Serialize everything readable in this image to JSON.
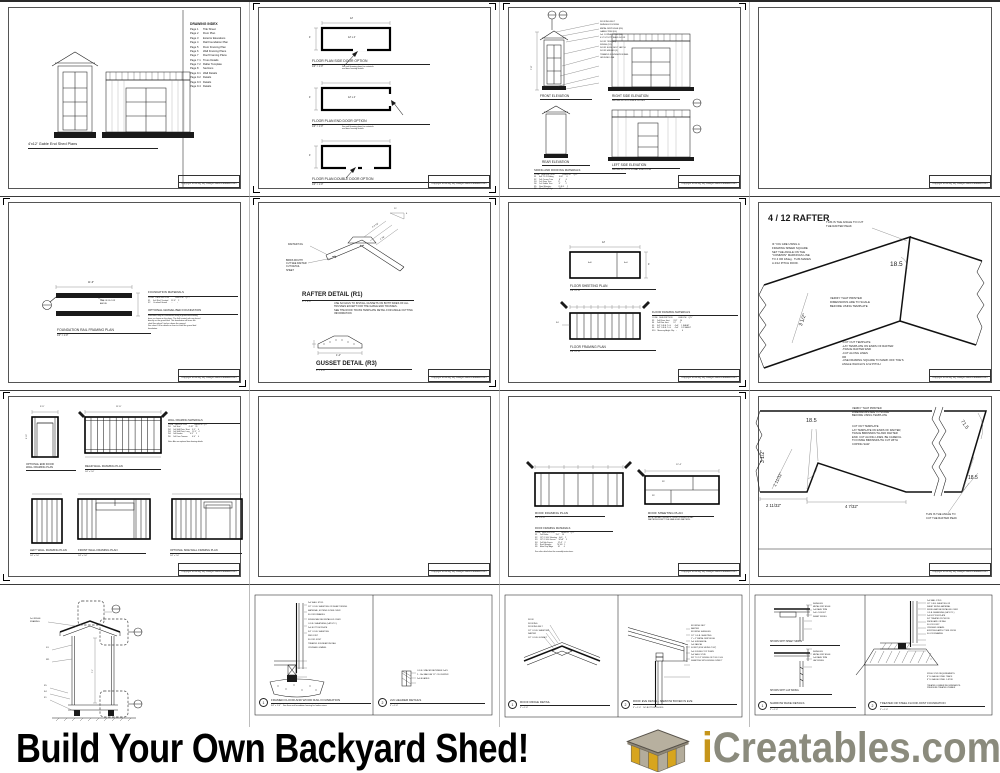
{
  "footer": {
    "headline": "Build Your Own Backyard Shed!",
    "brand": {
      "i": "i",
      "name": "Creatables",
      "dot": ".",
      "tld": "com"
    },
    "colors": {
      "gold": "#C6951A",
      "gray": "#8B8B7D",
      "dot": "#8B8B7D",
      "roof": "#b7b09f",
      "panel_gold": "#D7A51E",
      "panel_gray": "#b3ac9b"
    }
  },
  "titleblock": "Copyright 2012 Big Sky Designs   www.icreatables.com",
  "common": {
    "q": "1/4\" = 1'-0\"",
    "three": "3\" = 1'-0\""
  },
  "sheets": {
    "s1": {
      "index_title": "DRAWING INDEX",
      "index": "Page 1      Title Sheet\nPage 2      Floor Plan\nPage 3      Exterior Elevations\nPage 4      Rail Foundation Plan\nPage 5      Floor Framing Plan\nPage 6      Wall Framing Plans\nPage 7      Roof Framing Plans\nPage 7.1   Truss Details\nPage 7.2   Rafter Template\nPage 8      Sections\nPage 9.1   Wall Details\nPage 9.2   Details\nPage 9.3   Details\nPage 9.4   Details",
      "caption": "4'x12' Gable End Shed Plans"
    },
    "s2": {
      "plan1": "FLOOR PLAN SIDE DOOR OPTION",
      "plan2": "FLOOR PLAN END DOOR OPTION",
      "plan3": "FLOOR PLAN DOUBLE DOOR OPTION",
      "note": "See wall framing plans for materials\nand door framing details.",
      "dim_w": "12'",
      "dim_h": "4'",
      "room": "12' x 4'"
    },
    "s3": {
      "front": "FRONT ELEVATION",
      "right": "RIGHT SIDE ELEVATION",
      "right_sub": "SHOWN WITH DOUBLE DOORS",
      "rear": "REAR ELEVATION",
      "left": "LEFT SIDE ELEVATION",
      "left_sub": "SHOWN WITH OPTIONAL SIDE DOOR",
      "callouts": "ROOFING FELT\nSHINGLE ROOFING\nMETAL DRIP EDGE (R6)\nGABLE TRIM (D6)\n1x4 CORNER TRIM (S2)\n4'-0\" UTILITY SHED DOOR\nDOOR TRIM (D3)\nSIDING (S1)\nDOOR SLIDE BOLT LATCH\nDOOR HINGES (3)\nTREATED FOUNDATION RAIL\nGROUND LINE",
      "dim": "7'-8\"",
      "mat_title": "SIDING AND ROOFING MATERIALS",
      "materials": "CODE   DESCRIPTION               LENGTH      QTY\nS1     4x8 T1-11 Siding          4'x8'       6\nS2     1x4 Corner Trim           8'          6\nD3     1x4 Door Trim             8'          4\nD6     1x4 Gable Trim            8'          2\nR5     Roof Shingles             70 S.F.     1\nR6     Metal Drip Edge           10'         4"
    },
    "s5": {
      "label": "FOUNDATION RAIL FRAMING PLAN",
      "dim": "11'-6\"",
      "note": "LINE OF FLOOR\nABOVE",
      "mat_title": "FOUNDATION MATERIALS",
      "materials": "CODE   DESCRIPTION           LENGTH    QTY\nF1     4x4 Rail, Treated     11'-6\"    2\nF2     Crushed Gravel        -         -",
      "opt_title": "OPTIONAL GRAVEL BED FOUNDATION",
      "opt_text": "Shed floor may be constructed using a gravel bed leveling\nbase as shown on the plans. The 4x4 treated rails are placed\ndirectly on the gravel bed. This foundation will leave the\nshed floor about 5 inches above the ground.\nSee sheet 9.4 for details on how to install the gravel bed\nfoundation."
    },
    "s6": {
      "tail": "RAFTER TAIL",
      "birds": "BIRDS MOUTH\nCUT SEE RAFTER\nCUT DETAIL\nSHEET",
      "heading": "RAFTER DETAIL (R1)",
      "note": "USE 6d NAILS TO INSTALL GUSSETS ON BOTH SIDES OF ALL\nTRUSSES EXCEPT FOR THE GABLE END TRUSSES.\nSEE THE ROOF TRUSS TEMPLATE DETAIL FOR ANGLE CUTTING\nINFORMATION",
      "dim1": "2'-3 7/8\"",
      "dim2": "4 7/8\"",
      "slope12": "12",
      "slope4": "4",
      "gheading": "GUSSET DETAIL (R3)",
      "gdim": "1'-4\""
    },
    "s7": {
      "slabel": "FLOOR SHEETING PLAN",
      "flabel": "FLOOR FRAMING PLAN",
      "dim_w": "12'",
      "dim_h": "4'",
      "p1": "4x8",
      "p2": "4x4",
      "rim": "F4",
      "ttitle": "FLOOR FRAMING MATERIALS",
      "table": "CODE   DESCRIPTION           LENGTH    QTY\nF3     2x4 Floor Joist       3'-9\"     10\nF4     2x4 Rim Joist         12'       2\nF5     3/4\" O.S.B. T+G       4'x8'     1 SHEET\nF6     3/4\" O.S.B. T+G       4'x4'     1/2 SHEET\nF10    Masonry Angle Clip    -         6"
    },
    "s8": {
      "title": "4 / 12 RAFTER",
      "peak_note": "THIS IS THE ANGLE TO CUT\nTHE RAFTER PEAK",
      "speed_note": "IF YOU ARE USING A\nFRAMING SPEED SQUARE\nSET THE ANGLE ON THE\n\"COMMON\" MARKINGS LINE\nTO 4 OR 18deg.  THIS MAKES\nA 4/12 PITCH ROOF.",
      "angle": "18.5",
      "verify": "VERIFY THAT PRINTED\nDIMENSIONS ARE TO SCALE\nBEFORE USING TEMPLATE",
      "steps": "-CUT OUT TEMPLATE\n-LAY TEMPLATE ON ENDS OF RAFTER\n-TRACE RAFTER END\n-CUT ALONG LINES\nOR\n-USE FRAMING SQUARE TO MARK OFF TOE'S\nANGLE WHICH IS 4/12 PITCH",
      "dim": "3 1/2\""
    },
    "s9": {
      "t1": "OPTIONAL END DOOR\nWALL FRAMING PLAN",
      "t2": "REAR WALL FRAMING PLAN",
      "t3": "LEFT WALL FRAMING PLAN",
      "t4": "FRONT WALL FRAMING PLAN",
      "t5": "OPTIONAL SIDE WALL FRAMING PLAN",
      "ttitle": "WALL FRAMING MATERIALS",
      "table": "CODE   DESCRIPTION              L0ENGTH   QTY\nW1     2x4 Stud                 6'-10\"    26\nW2     2x4 Wall Plate, Short    3'-5\"     4\nW3     2x4 Wall Plate, Long     11'-5\"    4\nW4     2x6 Header               4'-5\"     2\nW5     2x4 Door Trimmer         6'-4\"     4",
      "note": "Note: Also see optional door framing details.",
      "d1": "3'-5\"",
      "d2": "11'-5\"",
      "d3": "6'-10\""
    },
    "s11": {
      "frlabel": "ROOF FRAMING PLAN",
      "ftitle": "ROOF FRAMING MATERIALS",
      "ftable": "CODE   DESCRIPTION             LENGTH    QTY\nR1     2x4 Rafter              3'-0\"     14\nR2     1/2\" O.S.B. Sheeting    4'x8'     2\nR3     1/2\" O.S.B. Gusset      16\"x8\"    5\nR4     2x4 Sub Fascia          12'-4\"    2\nR5     Roof Shingles           70 S.F.   1\nR6     Metal Drip Edge         10'       4",
      "fnote": "See rafter detail sheet for assembly instructions.",
      "shlabel": "ROOF SHEETING PLAN",
      "shnote": "NOTE: INSTALL GUSSETS ON BOTH SIDES OF ALL\nRAFTERS EXCEPT THE GABLE END RAFTERS.",
      "dim": "12'-4\"",
      "p1": "R2",
      "p2": "R2"
    },
    "s12": {
      "verify": "VERIFY THAT PRINTED\nDIMENSIONS ARE TO SCALE\nBEFORE USING TEMPLATE",
      "steps": "CUT OUT TEMPLATE\nLAY TEMPLATE ON ENDS OF RAFTER,\nTRACE BIRDSMOUTH AND RAFTER\nEND. CUT ALONG LINES. BE CAREFUL\nTO FINISH BIRDSMOUTH CUT WITH\nCOPING SAW",
      "peak_note": "THIS IS THE ANGLE TO\nCUT THE RAFTER PEAK",
      "angle1": "18.5",
      "angle2": "71.5",
      "angle3": "18.5",
      "dim1": "3 1/2\"",
      "dim2": "1 11/32\"",
      "dim3": "2 11/32\"",
      "dim4": "4 7/32\""
    },
    "s13": {
      "ridge_note": "2x4 RIDGE\nFRAMING",
      "c1": "S1",
      "c2": "W1",
      "c3": "F5",
      "c4": "F4",
      "c5": "F1",
      "dim": "7'-1\""
    },
    "s14": {
      "left_num": "1",
      "left_title": "FRAMED FLOOR AND WOOD RAIL FOUNDATION",
      "left_scale": "3/4\" = 1'-0\"    See floor and foundation framing for lumber sizes.",
      "left_callouts": "2x4 WALL STUD\n1/2\" O.S.B. SHEETING OR SHEET SIDING\nMATERIAL, EXTEND DOWN OVER\nFLOOR FRAMING\nSIDING MAY BE INSTALLED OVER\nO.S.B. SHEATHING (LAP ETC.)\n2x4 BOTTOM PLATE\n3/4\" O.S.B. SHEETING\nRIM JOIST\nFLOOR JOIST\nTREATED FOUNDATION RAIL\nCRUSHED GRAVEL",
      "right_num": "2",
      "right_title": "2x6 HEADER DETAILS",
      "right_callouts": "O.S.B. SPACER BETWEEN 2x6'S\n2 - 16d NAILS AT 12\" ON CENTER\n2x6 BOARDS"
    },
    "s15": {
      "ridge_num": "1",
      "ridge_title": "ROOF RIDGE DETAIL",
      "ridge_callouts": "ROOF\nROOFING\nROOFING FELT\n1/2\" O.S.B. SHEETING\nRAFTER\n1/2\" O.S.B. GUSSET",
      "eave_num": "2",
      "eave_title": "ROOF EVE DETAIL - NARROW BOXED IN EVE",
      "eave_scale": "3\" = 1'-0\"    NO BOTTOM CHORD",
      "eave_callouts": "ROOFING FELT\nRAFTER\nROOFING SHINGLES\n1/2\" O.S.B. SHEETING\n1\" x 2\" METAL DRIP EDGE\n2x4 SUB FASCIA\n1x4 FASCIA\nSOFFIT (EVE SIDING 7/16\")\n2x4 DOUBLE TOP PLATE\n2x4 WALL STUD\n3/8\" TO 1/2\" SIDING OR 7/16 O.S.B.\nSHEETING WITH SIDING OVER IT"
    },
    "s16": {
      "rake_num": "1",
      "rake_title": "NARROW RAKE DETAILS",
      "cap1": "SHOWN WITH SHEET SIDING",
      "cap2": "SHOWN WITH LAP SIDING",
      "callouts1": "SHINGLES\nMETAL DRIP EDGE\n1x4 RAKE TRIM\n2x4 LOOKOUT\nSHEET SIDING",
      "callouts2": "SHINGLES\nMETAL DRIP EDGE\n1x4 RAKE TRIM\nLAP SIDING",
      "found_num": "2",
      "found_title": "TREATED OR STEEL FLOOR JOIST FOUNDATION",
      "found_callouts": "2x4 WALL STUD\n1/2\" O.S.B. SHEETING OR\nSHEET SIDING MATERIAL\nSIDING MAY BE INSTALLED OVER\nO.S.B. SHEATHING (LAP ETC.)\n2x4 BOTTOM PLATE\n3/4\" TREATED PLYWOOD\nRIM BOARD OR RAIL\nFLOOR JOIST\nCRUSHED GRAVEL\nEXISTING EARTH 2\" MIN. FROM\nFLOOR FRAMING",
      "found_req": "STEEL STUD REQUIREMENTS:\n8\" 16 GAUGE STEEL TRACK\n8\" 16 GAUGE STEEL C-STUD\n\nTREATED LUMBER REQUIREMENTS:\nPRESSURE TREATED LUMBER"
    }
  }
}
